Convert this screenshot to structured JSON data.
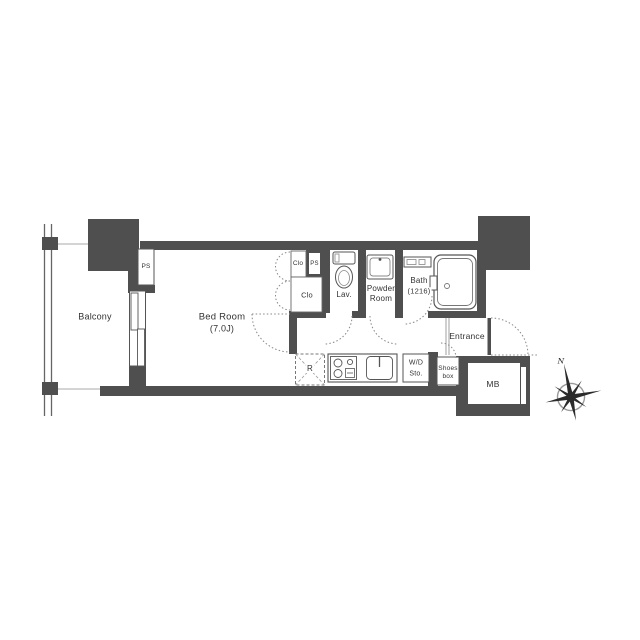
{
  "colors": {
    "wall": "#4f4f4f",
    "outline": "#555555",
    "door_dotted": "#888888",
    "text": "#333333",
    "background": "#ffffff"
  },
  "rooms": {
    "balcony": {
      "label": "Balcony"
    },
    "bedroom": {
      "label": "Bed Room",
      "size": "(7.0J)"
    },
    "pipe_space_balcony": {
      "label": "PS"
    },
    "closet_upper": {
      "label": "Clo"
    },
    "pipe_space_inner": {
      "label": "PS"
    },
    "closet_lower": {
      "label": "Clo"
    },
    "lavatory": {
      "label": "Lav."
    },
    "powder_room": {
      "label_line1": "Powder",
      "label_line2": "Room"
    },
    "bath": {
      "label": "Bath",
      "size": "(1216)"
    },
    "entrance": {
      "label": "Entrance"
    },
    "refrigerator_space": {
      "label": "R"
    },
    "washer_dryer_storage": {
      "label_line1": "W/D",
      "label_line2": "Sto."
    },
    "shoes_box": {
      "label_line1": "Shoes",
      "label_line2": "box"
    },
    "meter_box": {
      "label": "MB"
    }
  },
  "compass": {
    "north_label": "N"
  }
}
